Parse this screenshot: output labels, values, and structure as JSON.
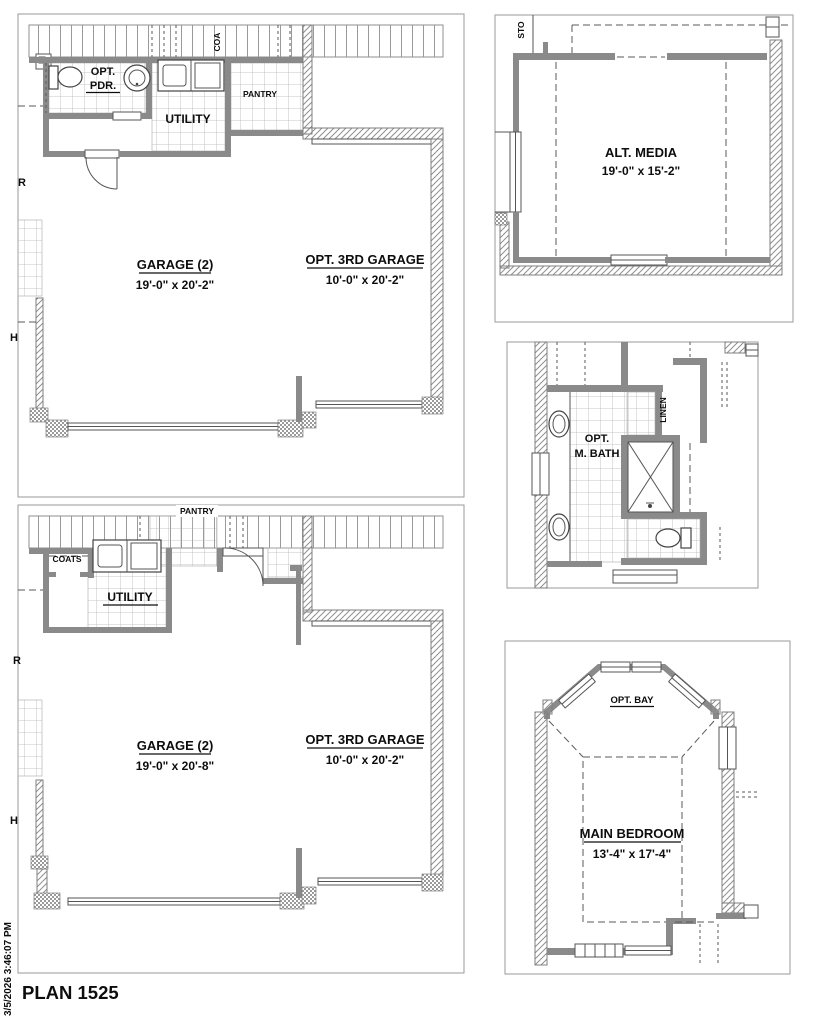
{
  "plan": {
    "title": "PLAN 1525",
    "timestamp": "3/5/2026 3:46:07 PM"
  },
  "colors": {
    "wall_gray": "#8a8a8a",
    "line": "#555555",
    "text": "#0d0d0d",
    "tile_line": "#b5b5b5"
  },
  "garage_plan_a": {
    "garage_label": "GARAGE (2)",
    "garage_dims": "19'-0\" x 20'-2\"",
    "third_garage_label": "OPT. 3RD GARAGE",
    "third_garage_dims": "10'-0\" x 20'-2\"",
    "powder_line1": "OPT.",
    "powder_line2": "PDR.",
    "utility_label": "UTILITY",
    "pantry_label": "PANTRY",
    "coats_partial": "COA",
    "edge_label_r": "R",
    "edge_label_h": "H"
  },
  "alt_media": {
    "room_label": "ALT. MEDIA",
    "room_dims": "19'-0\" x 15'-2\"",
    "storage_partial": "STO"
  },
  "master_bath": {
    "room_line1": "OPT.",
    "room_line2": "M. BATH",
    "linen_label": "LINEN"
  },
  "garage_plan_b": {
    "garage_label": "GARAGE (2)",
    "garage_dims": "19'-0\" x 20'-8\"",
    "third_garage_label": "OPT. 3RD GARAGE",
    "third_garage_dims": "10'-0\" x 20'-2\"",
    "utility_label": "UTILITY",
    "pantry_label": "PANTRY",
    "coats_label": "COATS",
    "edge_label_r": "R",
    "edge_label_h": "H"
  },
  "main_bedroom": {
    "room_label": "MAIN BEDROOM",
    "room_dims": "13'-4\" x 17'-4\"",
    "bay_label": "OPT. BAY"
  }
}
